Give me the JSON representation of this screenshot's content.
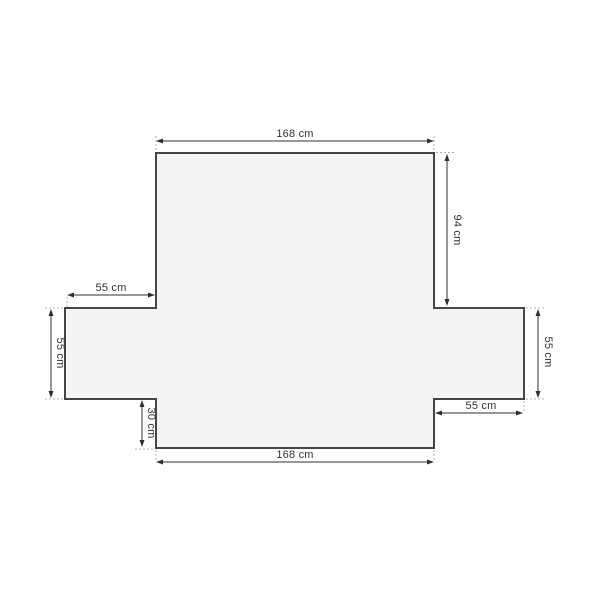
{
  "diagram": {
    "name": "sofa-cover-dimension-diagram",
    "unit": "cm",
    "colors": {
      "background": "#ffffff",
      "shape_fill": "#f4f4f5",
      "shape_outline": "#454545",
      "dimension_line": "#2f2f2f",
      "extension_dash": "#b0b0b0",
      "label_text": "#333333"
    },
    "dimensions": {
      "top_width": {
        "label": "168 cm",
        "value": 168
      },
      "back_height": {
        "label": "94 cm",
        "value": 94
      },
      "left_arm_width": {
        "label": "55 cm",
        "value": 55
      },
      "left_arm_height": {
        "label": "55 cm",
        "value": 55
      },
      "front_flap_height": {
        "label": "30 cm",
        "value": 30
      },
      "right_arm_height": {
        "label": "55 cm",
        "value": 55
      },
      "right_arm_width": {
        "label": "55 cm",
        "value": 55
      },
      "bottom_width": {
        "label": "168 cm",
        "value": 168
      }
    }
  }
}
